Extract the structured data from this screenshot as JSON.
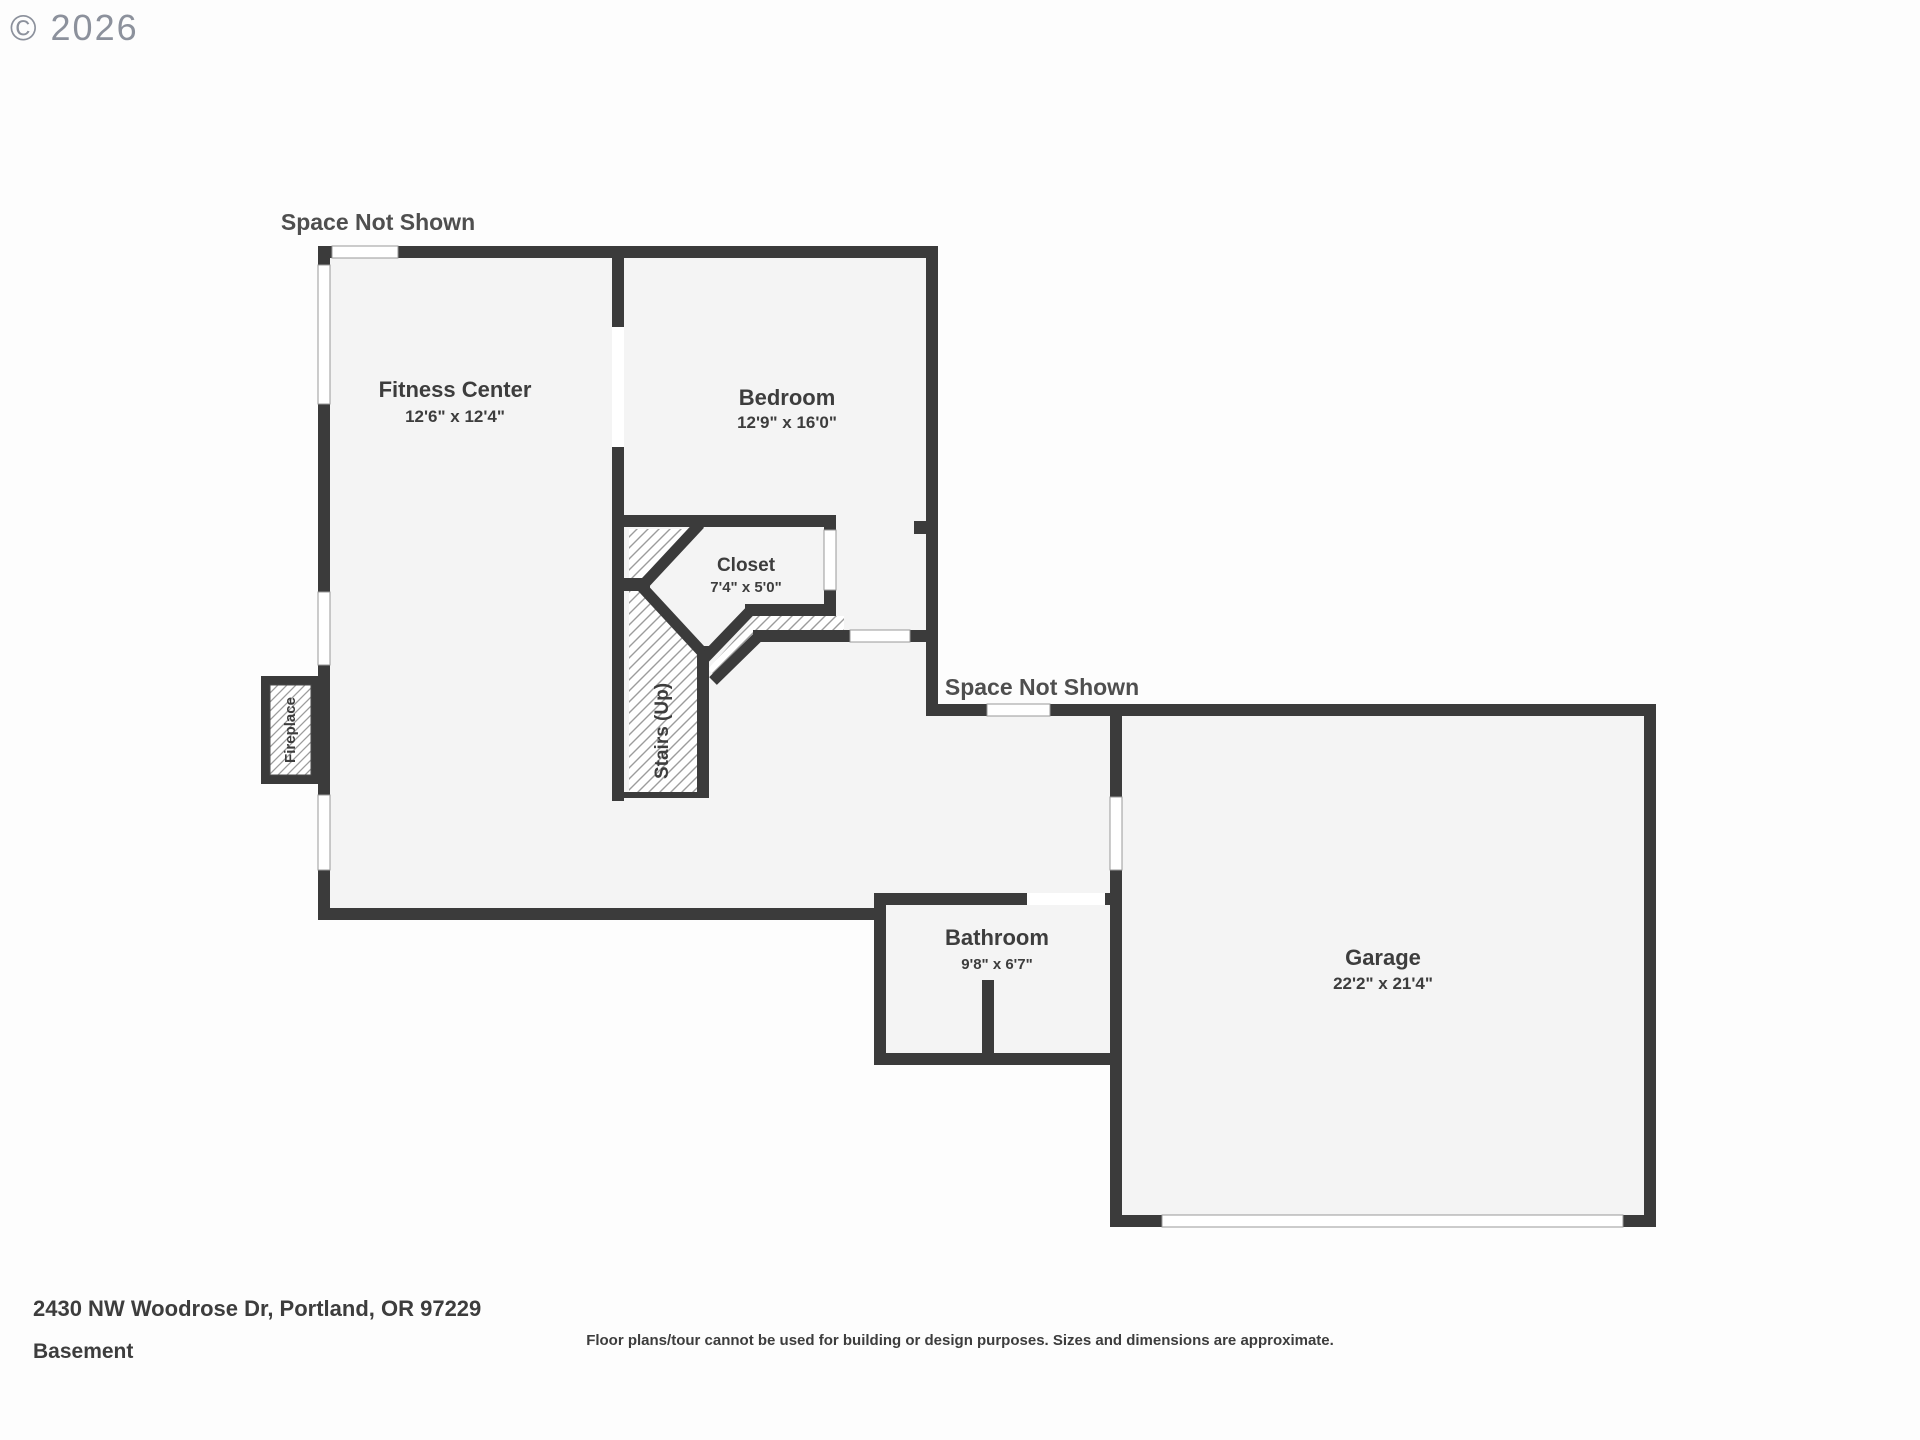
{
  "copyright": "© 2026",
  "colors": {
    "wall": "#3b3b3b",
    "floor": "#f4f4f4",
    "hatch_line": "#9c9c9c",
    "label_text": "#3d3d3d",
    "space_not_shown_text": "#4f4f4f",
    "copyright_text": "#8c919c",
    "background": "#fdfdfd"
  },
  "plan": {
    "space_not_shown_top": "Space Not Shown",
    "space_not_shown_middle": "Space Not Shown",
    "rooms": {
      "fitness": {
        "name": "Fitness Center",
        "dims": "12'6\" x 12'4\""
      },
      "bedroom": {
        "name": "Bedroom",
        "dims": "12'9\" x 16'0\""
      },
      "closet": {
        "name": "Closet",
        "dims": "7'4\" x 5'0\""
      },
      "bathroom": {
        "name": "Bathroom",
        "dims": "9'8\" x 6'7\""
      },
      "garage": {
        "name": "Garage",
        "dims": "22'2\" x 21'4\""
      },
      "stairs": {
        "name": "Stairs (Up)"
      },
      "fireplace": {
        "name": "Fireplace"
      }
    }
  },
  "footer": {
    "address": "2430 NW Woodrose Dr, Portland, OR 97229",
    "level": "Basement",
    "disclaimer": "Floor plans/tour cannot be used for building or design purposes. Sizes and dimensions are approximate."
  }
}
